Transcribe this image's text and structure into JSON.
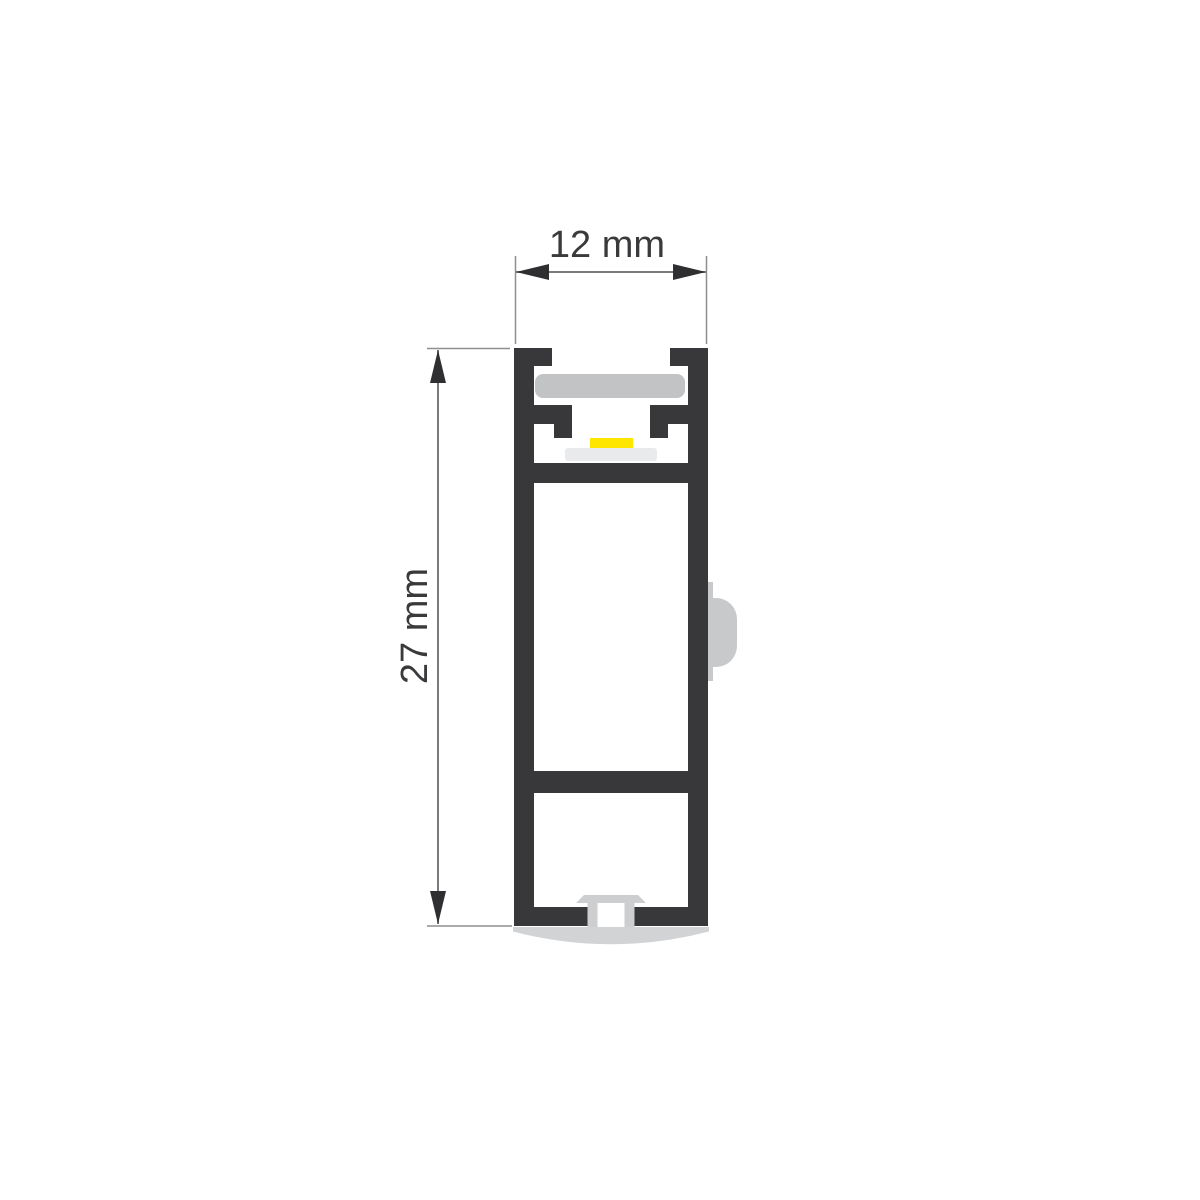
{
  "diagram": {
    "dimensions": {
      "width": {
        "value": 12,
        "unit": "mm",
        "label": "12 mm"
      },
      "height": {
        "value": 27,
        "unit": "mm",
        "label": "27 mm"
      }
    },
    "colors": {
      "background": "#ffffff",
      "profile_body": "#38383a",
      "diffuser": "#c2c3c5",
      "led_strip": "#ffe600",
      "led_base": "#e9eaec",
      "screw_channel": "#cdced0",
      "bottom_lens": "#d2d3d5",
      "mounting_clip": "#c8c9cb",
      "dimension_line": "#7a7b7d",
      "extension_line": "#8e8f91",
      "arrow": "#2f2f31",
      "text": "#3a3a3c"
    }
  }
}
